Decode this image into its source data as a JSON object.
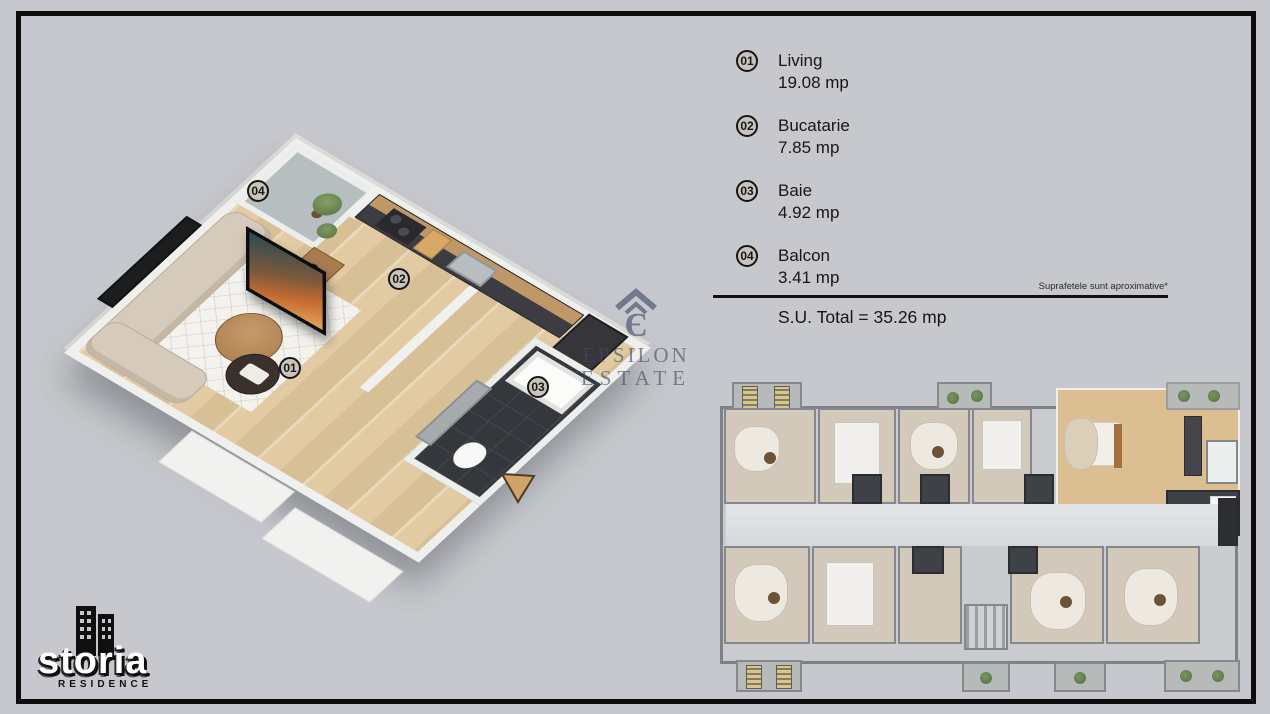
{
  "colors": {
    "background": "#c6c8cd",
    "frame": "#0e0e0e",
    "badge_fill": "#c9c4ba",
    "wood_floor": "#dcc096",
    "entrance_arrow": "#d2a368",
    "estate_watermark": "#3e4c66",
    "bath_tile": "#34373c"
  },
  "legend": {
    "items": [
      {
        "num": "01",
        "name": "Living",
        "area": "19.08 mp"
      },
      {
        "num": "02",
        "name": "Bucatarie",
        "area": "7.85 mp"
      },
      {
        "num": "03",
        "name": "Baie",
        "area": "4.92 mp"
      },
      {
        "num": "04",
        "name": "Balcon",
        "area": "3.41 mp"
      }
    ],
    "disclaimer": "Suprafetele sunt aproximative*",
    "total": "S.U. Total = 35.26 mp"
  },
  "scene3d": {
    "labels": [
      "01",
      "02",
      "03",
      "04"
    ]
  },
  "watermark_estate": {
    "line1": "EPSILON",
    "line2": "ESTATE"
  },
  "logo": {
    "watermark": "storia",
    "residence": "RESIDENCE"
  }
}
